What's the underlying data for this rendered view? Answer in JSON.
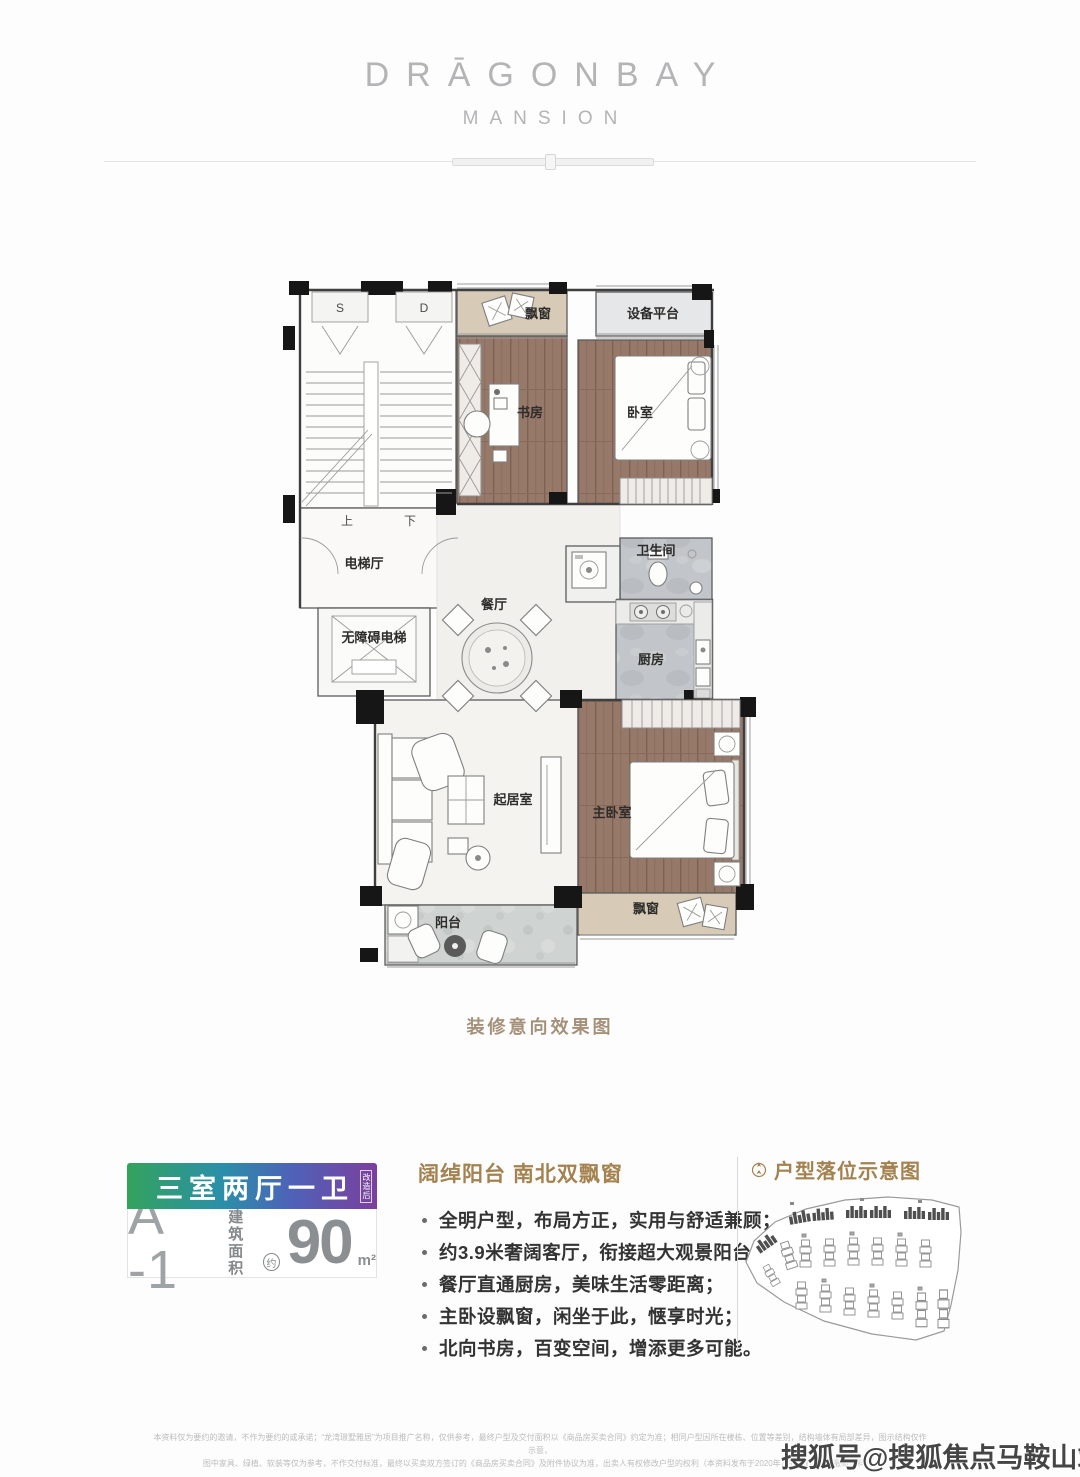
{
  "brand": {
    "title": "DRĀGONBAY",
    "subtitle": "MANSION"
  },
  "floor_plan": {
    "caption": "装修意向效果图",
    "labels": {
      "stair_door_s": "S",
      "stair_door_d": "D",
      "bay_window_top": "飘窗",
      "equipment_platform": "设备平台",
      "study": "书房",
      "bedroom": "卧室",
      "up": "上",
      "down": "下",
      "elevator_hall": "电梯厅",
      "accessible_elevator": "无障碍电梯",
      "dining_room": "餐厅",
      "bathroom": "卫生间",
      "kitchen": "厨房",
      "living_room": "起居室",
      "master_bedroom": "主卧室",
      "balcony": "阳台",
      "bay_window_bottom": "飘窗"
    }
  },
  "unit_card": {
    "layout": "三室两厅一卫",
    "layout_note": "改造后",
    "unit_code": "A -1",
    "area_label_top": "建筑",
    "area_label_bottom": "面积",
    "approx": "约",
    "area_value": "90",
    "area_unit": "m²",
    "gradient_left": "#33a35d",
    "gradient_mid": "#2a8fa9",
    "gradient_right": "#7c3f9e"
  },
  "features": {
    "heading": "阔绰阳台 南北双飘窗",
    "bullets": [
      "全明户型，布局方正，实用与舒适兼顾；",
      "约3.9米奢阔客厅，衔接超大观景阳台；",
      "餐厅直通厨房，美味生活零距离；",
      "主卧设飘窗，闲坐于此，惬享时光；",
      "北向书房，百变空间，增添更多可能。"
    ]
  },
  "site_plan": {
    "heading": "户型落位示意图"
  },
  "fine_print": {
    "line1": "本资料仅为要约的邀请，不作为要约的或承诺；“龙湾璟墅雅居”为项目推广名称，仅供参考，最终户型及交付面积以《商品房买卖合同》约定为准；相同户型因所在楼栋、位置等差别，结构墙体有局部差异，图示结构仅作示意，",
    "line2": "图中家具、绿植、软装等仅为参考，不作交付标准，最终以买卖双方签订的《商品房买卖合同》及附件协议为准，出卖人有权修改户型的权利（本资料发布于2020年7月，敬请留意最新资料）。"
  },
  "watermark": "搜狐号@搜狐焦点马鞍山站",
  "colors": {
    "accent_brown": "#a3824f",
    "caption_brown": "#a5917a"
  }
}
